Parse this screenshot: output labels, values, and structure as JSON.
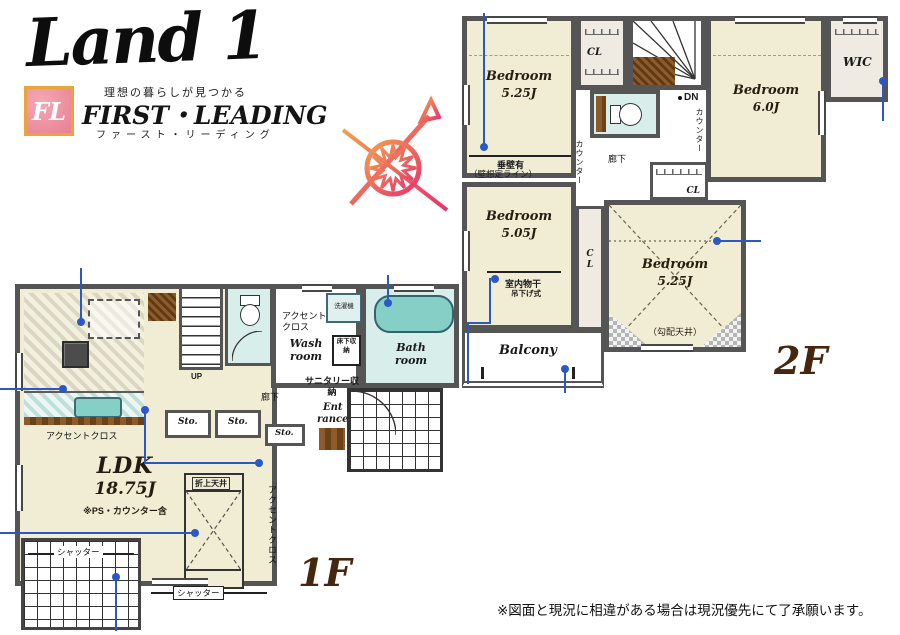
{
  "branding": {
    "logo": "Land 1",
    "fl_monogram": "FL",
    "tagline": "理想の暮らしが見つかる",
    "company_en": "FIRST・LEADING",
    "company_kana": "ファースト・リーディング"
  },
  "floor_1": {
    "label": "1F",
    "ldk_name": "LDK",
    "ldk_size": "18.75J",
    "ldk_note": "※PS・カウンター含",
    "wash_room": "Wash room",
    "bath_room": "Bath room",
    "entrance_line1": "Ent",
    "entrance_line2": "rance",
    "hallway": "廊下",
    "storage_abbr": "Sto.",
    "up": "UP",
    "washer": "洗濯機",
    "underfloor_storage": "床下収納",
    "sanitary_storage": "サニタリー収納",
    "accent_cloth": "アクセントクロス",
    "coffered_ceiling": "折上天井",
    "shutter": "シャッター"
  },
  "floor_2": {
    "label": "2F",
    "bedroom_a_name": "Bedroom",
    "bedroom_a_size": "5.25J",
    "bedroom_b_name": "Bedroom",
    "bedroom_b_size": "6.0J",
    "bedroom_c_name": "Bedroom",
    "bedroom_c_size": "5.05J",
    "bedroom_d_name": "Bedroom",
    "bedroom_d_size": "5.25J",
    "wic": "WIC",
    "closet_abbr": "CL",
    "down": "DN",
    "counter": "カウンター",
    "hallway": "廊下",
    "balcony": "Balcony",
    "hanging_wall": "垂壁有",
    "wall_assumed_line": "（壁想定ライン）",
    "indoor_drying": "室内物干",
    "hanging_type": "吊下げ式",
    "sloped_ceiling": "（勾配天井）"
  },
  "disclaimer": "※図面と現況に相違がある場合は現況優先にて了承願います。",
  "colors": {
    "wall": "#555555",
    "room_fill": "#f1edd4",
    "wet_area_fill": "#d7eeea",
    "tub_fill": "#86cfc6",
    "wood": "#8d5b2b",
    "annotation_blue": "#2b59c3",
    "floor_label_brown": "#47260f",
    "logo_pink": "#ec8e9c",
    "logo_gold": "#e9a43b"
  }
}
